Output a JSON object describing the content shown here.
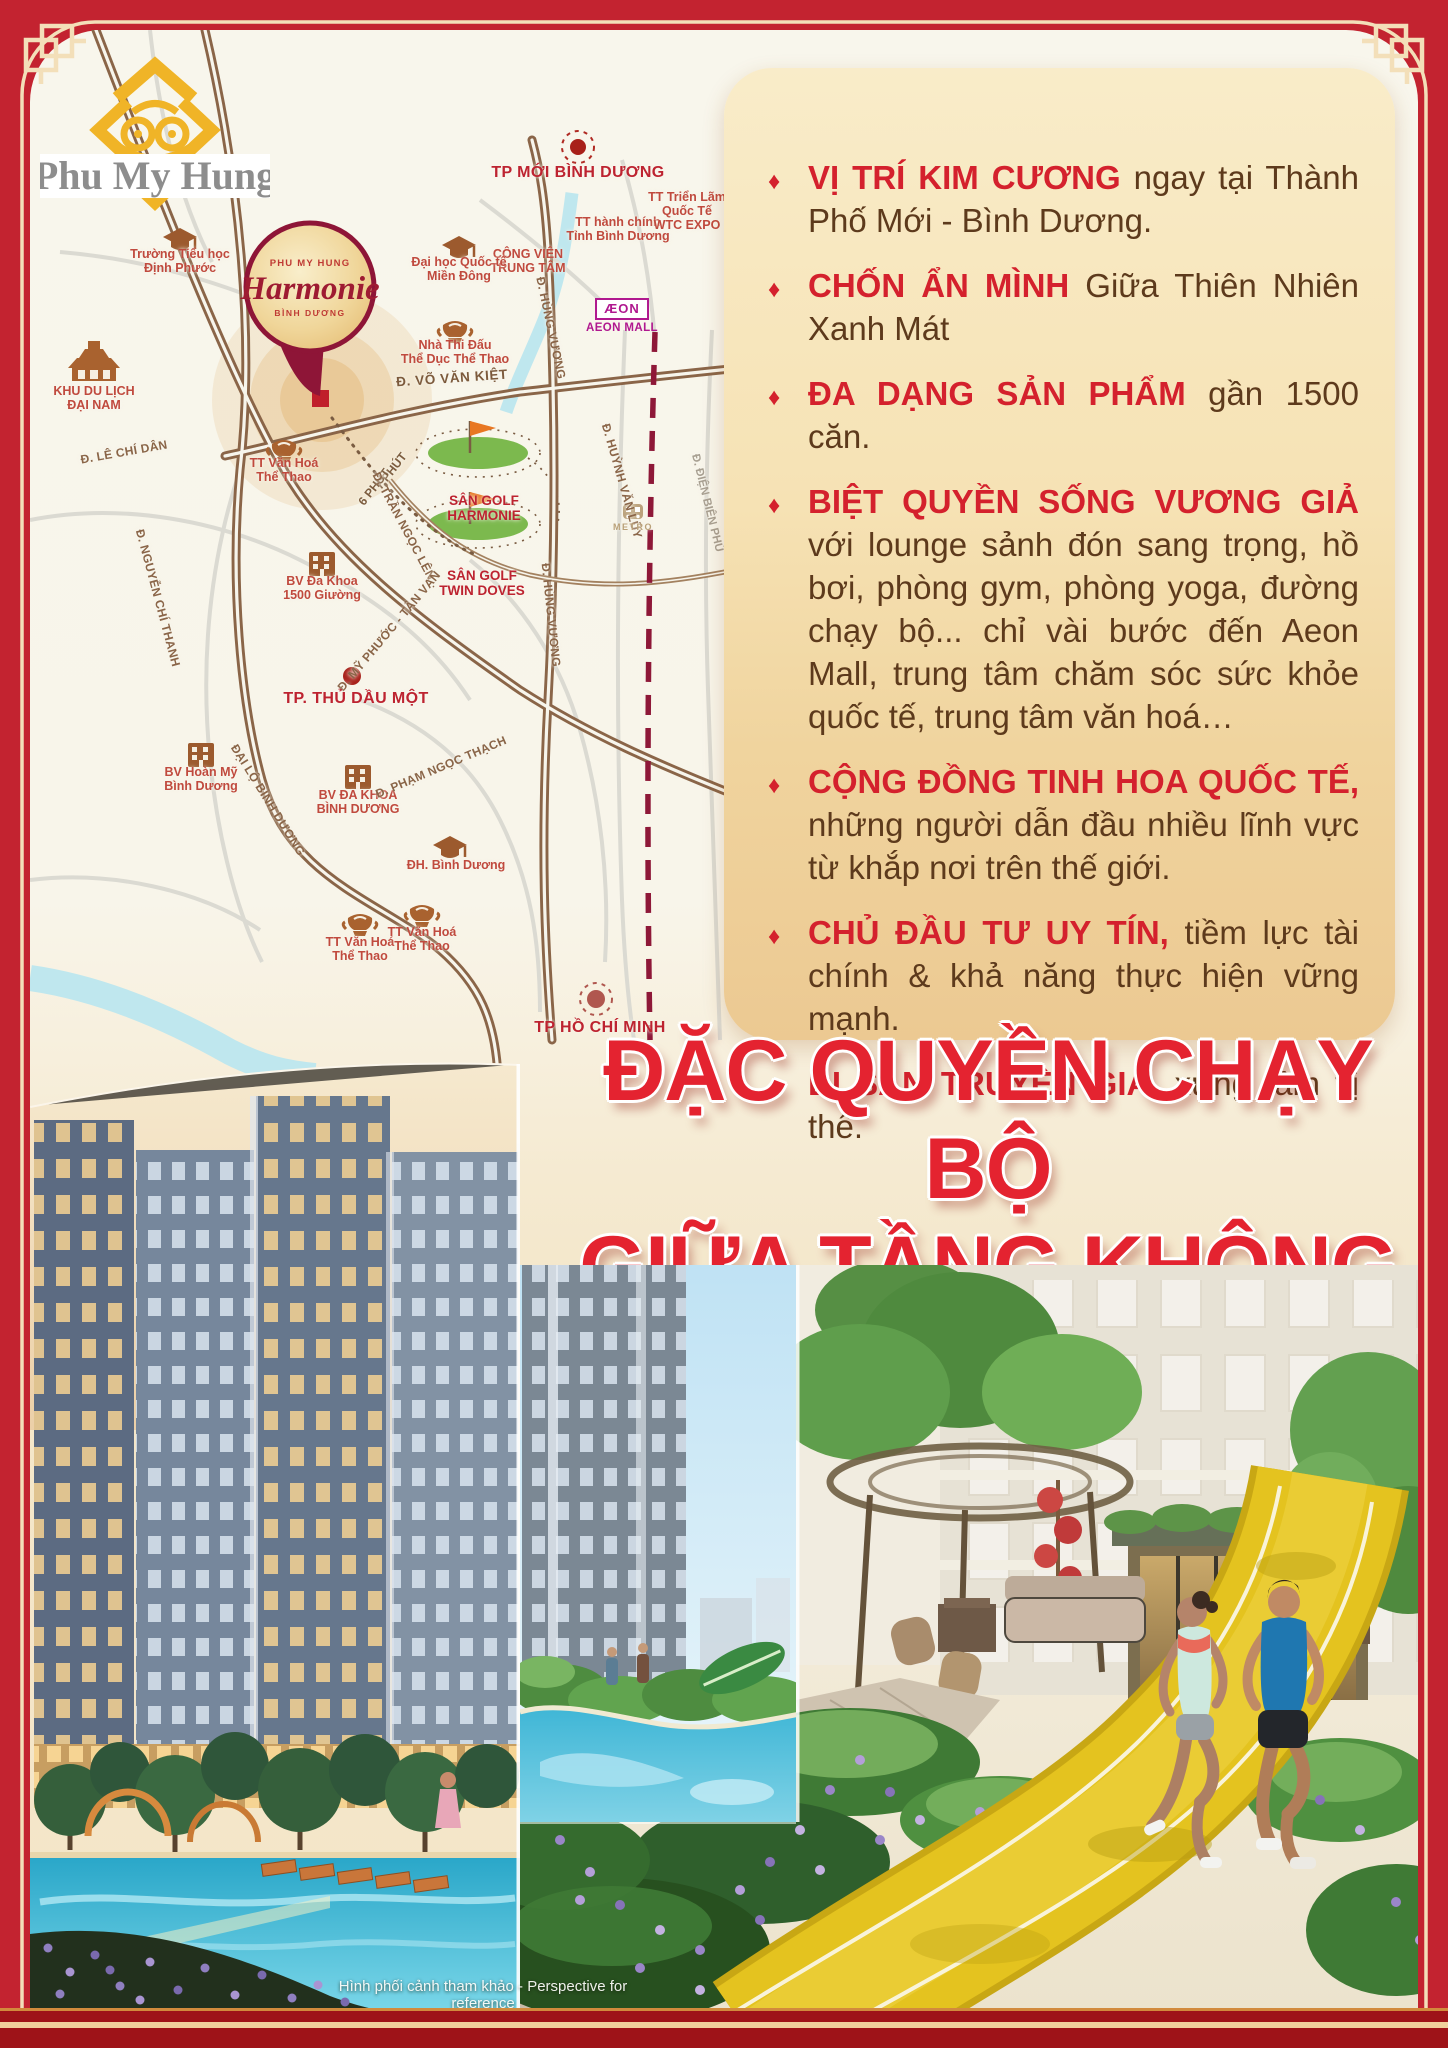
{
  "logo": {
    "brand": "Phu My Hung"
  },
  "map": {
    "balloon": {
      "brand": "PHU MY HUNG",
      "name": "Harmonie",
      "province": "BÌNH DƯƠNG"
    },
    "aeon": {
      "logo": "ÆON",
      "label": "AEON MALL"
    },
    "labels": [
      {
        "id": "tpmoi",
        "kind": "city",
        "text": "TP MỚI BÌNH DƯƠNG"
      },
      {
        "id": "hanhchinh",
        "kind": "poi",
        "text": "TT hành chính\nTỉnh Bình Dương"
      },
      {
        "id": "trienlam",
        "kind": "poi",
        "text": "TT Triển Lãm\nQuốc Tế\nWTC EXPO"
      },
      {
        "id": "congvien",
        "kind": "poi",
        "text": "CÔNG VIÊN\nTRUNG TÂM"
      },
      {
        "id": "daihoc",
        "kind": "poi",
        "text": "Đại học Quốc tế\nMiền Đông"
      },
      {
        "id": "truonghoc",
        "kind": "poi",
        "text": "Trường  Tiểu học\nĐịnh Phước"
      },
      {
        "id": "nhathidau",
        "kind": "poi",
        "text": "Nhà Thi Đấu\nThể Dục Thể Thao"
      },
      {
        "id": "vovankiet",
        "kind": "roadlg",
        "text": "Đ. VÕ VĂN KIỆT"
      },
      {
        "id": "khudulich",
        "kind": "poi",
        "text": "KHU DU LỊCH\nĐẠI NAM"
      },
      {
        "id": "lechidan",
        "kind": "road",
        "text": "Đ. LÊ CHÍ DÂN"
      },
      {
        "id": "ttvanhoa1",
        "kind": "poi",
        "text": "TT Văn Hoá\nThể Thao"
      },
      {
        "id": "phut7",
        "kind": "min",
        "text": "7 PHÚT"
      },
      {
        "id": "phut6",
        "kind": "min",
        "text": "6 PHÚT"
      },
      {
        "id": "golfharmonie",
        "kind": "golf",
        "text": "SÂN GOLF\nHARMONIE"
      },
      {
        "id": "trangoclen",
        "kind": "road",
        "text": "Đ. TRẦN NGỌC LÊN"
      },
      {
        "id": "golftwindoves",
        "kind": "golf",
        "text": "SÂN GOLF\nTWIN DOVES"
      },
      {
        "id": "bv1500",
        "kind": "poi",
        "text": "BV Đa Khoa\n1500 Giường"
      },
      {
        "id": "nguyenchithanh",
        "kind": "road",
        "text": "Đ. NGUYỄN CHÍ THANH"
      },
      {
        "id": "myphuoc",
        "kind": "road",
        "text": "Đ. MỸ PHƯỚC - TÂN VẠN"
      },
      {
        "id": "thudaumot",
        "kind": "city",
        "text": "TP. THỦ DẦU MỘT"
      },
      {
        "id": "hungvuong1",
        "kind": "road",
        "text": "Đ. HÙNG VƯƠNG"
      },
      {
        "id": "hungvuong2",
        "kind": "road",
        "text": "Đ. HÙNG VƯƠNG"
      },
      {
        "id": "huynhvanluy",
        "kind": "road",
        "text": "Đ. HUỲNH VĂN LŨY"
      },
      {
        "id": "dienbienphu",
        "kind": "roadg",
        "text": "Đ. ĐIỆN BIÊN PHỦ"
      },
      {
        "id": "metro",
        "kind": "metro",
        "text": "METRO"
      },
      {
        "id": "bvhoanmy",
        "kind": "poi",
        "text": "BV Hoàn Mỹ\nBình Dương"
      },
      {
        "id": "dailobd",
        "kind": "road",
        "text": "ĐẠI LỘ BÌNH DƯƠNG"
      },
      {
        "id": "bvdakhoabd",
        "kind": "poi",
        "text": "BV ĐA KHOA\nBÌNH DƯƠNG"
      },
      {
        "id": "phamngocthach",
        "kind": "road",
        "text": "Đ. PHẠM NGỌC THẠCH"
      },
      {
        "id": "dhbinhduong",
        "kind": "poi",
        "text": "ĐH. Bình Dương"
      },
      {
        "id": "ttvanhoa2",
        "kind": "poi",
        "text": "TT Văn Hoá\nThể Thao"
      },
      {
        "id": "ttvanhoa3",
        "kind": "poi",
        "text": "TT Văn Hoá\nThể Thao"
      },
      {
        "id": "hcm",
        "kind": "city",
        "text": "TP HỒ CHÍ MINH"
      }
    ]
  },
  "panel": {
    "bullet_glyph": "♦",
    "features": [
      {
        "strong": "VỊ TRÍ KIM CƯƠNG",
        "text": " ngay tại Thành Phố Mới - Bình Dương."
      },
      {
        "strong": "CHỐN ẨN MÌNH",
        "text": " Giữa Thiên Nhiên Xanh Mát"
      },
      {
        "strong": "ĐA DẠNG SẢN PHẨM",
        "text": " gần 1500 căn."
      },
      {
        "strong": "BIỆT QUYỀN SỐNG VƯƠNG GIẢ",
        "text": " với lounge sảnh đón sang trọng, hồ bơi, phòng gym, phòng yoga, đường chạy bộ... chỉ vài bước đến Aeon Mall, trung tâm chăm sóc sức khỏe quốc tế, trung tâm văn hoá…"
      },
      {
        "strong": "CỘNG ĐỒNG TINH HOA QUỐC TẾ,",
        "text": " những người dẫn đầu nhiều lĩnh vực từ khắp nơi trên thế giới."
      },
      {
        "strong": "CHỦ ĐẦU TƯ UY TÍN,",
        "text": " tiềm lực tài chính & khả năng thực hiện vững mạnh."
      },
      {
        "strong": "DI SẢN TRUYỀN GIA,",
        "text": " xứng tầm vị thế."
      }
    ]
  },
  "headline": {
    "line1": "ĐẶC QUYỀN CHẠY BỘ",
    "line2": "GIỮA TẦNG KHÔNG",
    "subtitle": "An Exclusive Experience Of Running In The Sky"
  },
  "caption": "Hình phối cảnh tham khảo - Perspective for reference",
  "colors": {
    "frame_red": "#c32330",
    "headline_red": "#e42330",
    "bullet_red": "#d4212d",
    "panel_top": "#f9ecc9",
    "panel_bottom": "#ecc992",
    "text_brown": "#5d3a1c",
    "logo_gold": "#f0b427",
    "track_yellow": "#e4c31f",
    "map_road_brown": "#8a6548",
    "metro_line": "#8e1838",
    "aeon_purple": "#b0188f",
    "water_blue": "#bfe7ee"
  }
}
